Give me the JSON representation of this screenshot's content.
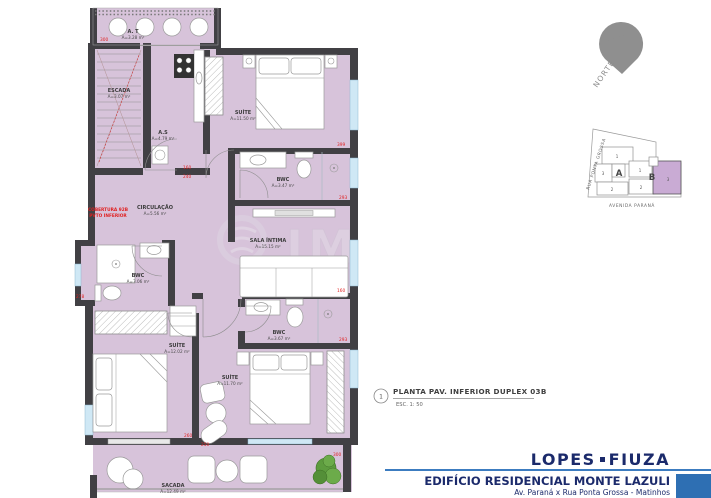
{
  "plan": {
    "rooms": [
      {
        "id": "at",
        "name": "A. T",
        "area": "A=3.28 m²"
      },
      {
        "id": "escada",
        "name": "ESCADA",
        "area": "A=3.07 m²"
      },
      {
        "id": "as",
        "name": "A.S",
        "area": "A=4.79 m²"
      },
      {
        "id": "suite-top",
        "name": "SUÍTE",
        "area": "A=11.50 m²"
      },
      {
        "id": "bwc-top",
        "name": "BWC",
        "area": "A=3.47 m²"
      },
      {
        "id": "circulacao",
        "name": "CIRCULAÇÃO",
        "area": "A=5.56 m²"
      },
      {
        "id": "sala-intima",
        "name": "SALA ÍNTIMA",
        "area": "A=15.15 m²"
      },
      {
        "id": "bwc-left",
        "name": "BWC",
        "area": "A=3.06 m²"
      },
      {
        "id": "suite-left",
        "name": "SUÍTE",
        "area": "A=12.02 m²"
      },
      {
        "id": "suite-mid",
        "name": "SUÍTE",
        "area": "A=11.70 m²"
      },
      {
        "id": "bwc-bottom",
        "name": "BWC",
        "area": "A=3.67 m²"
      },
      {
        "id": "sacada",
        "name": "SACADA",
        "area": "A=12.49 m²"
      }
    ],
    "red_note": {
      "line1": "COBERTURA 92B",
      "line2": "PVTO INFERIOR"
    },
    "dims": [
      "300",
      "399",
      "293",
      "160",
      "293",
      "278",
      "160",
      "240",
      "260",
      "250",
      "300"
    ],
    "watermark": "IM"
  },
  "north": {
    "label": "NORTE"
  },
  "keymap": {
    "street_left": "RUA PONTA GROSSA",
    "street_bottom": "AVENIDA PARANÁ",
    "block_a_label": "A",
    "block_b_label": "B",
    "units_a": [
      "1",
      "3",
      "2"
    ],
    "units_b": [
      "1",
      "2",
      "3"
    ]
  },
  "titleblock": {
    "ref": "1",
    "title": "PLANTA PAV. INFERIOR DUPLEX 03B",
    "scale": "ESC. 1: 50"
  },
  "brand": {
    "logo_left": "LOPES",
    "logo_right": "FIUZA",
    "building": "EDIFÍCIO RESIDENCIAL MONTE LAZULI",
    "address": "Av. Paraná x Rua Ponta Grossa - Matinhos"
  },
  "colors": {
    "room_fill": "#d7c3da",
    "wall": "#414044",
    "dim_red": "#e02020",
    "navy": "#1b2a6b",
    "rule_blue": "#3c7cc0",
    "square_blue": "#2e6fb3",
    "keymap_unit": "#c9abd4"
  }
}
